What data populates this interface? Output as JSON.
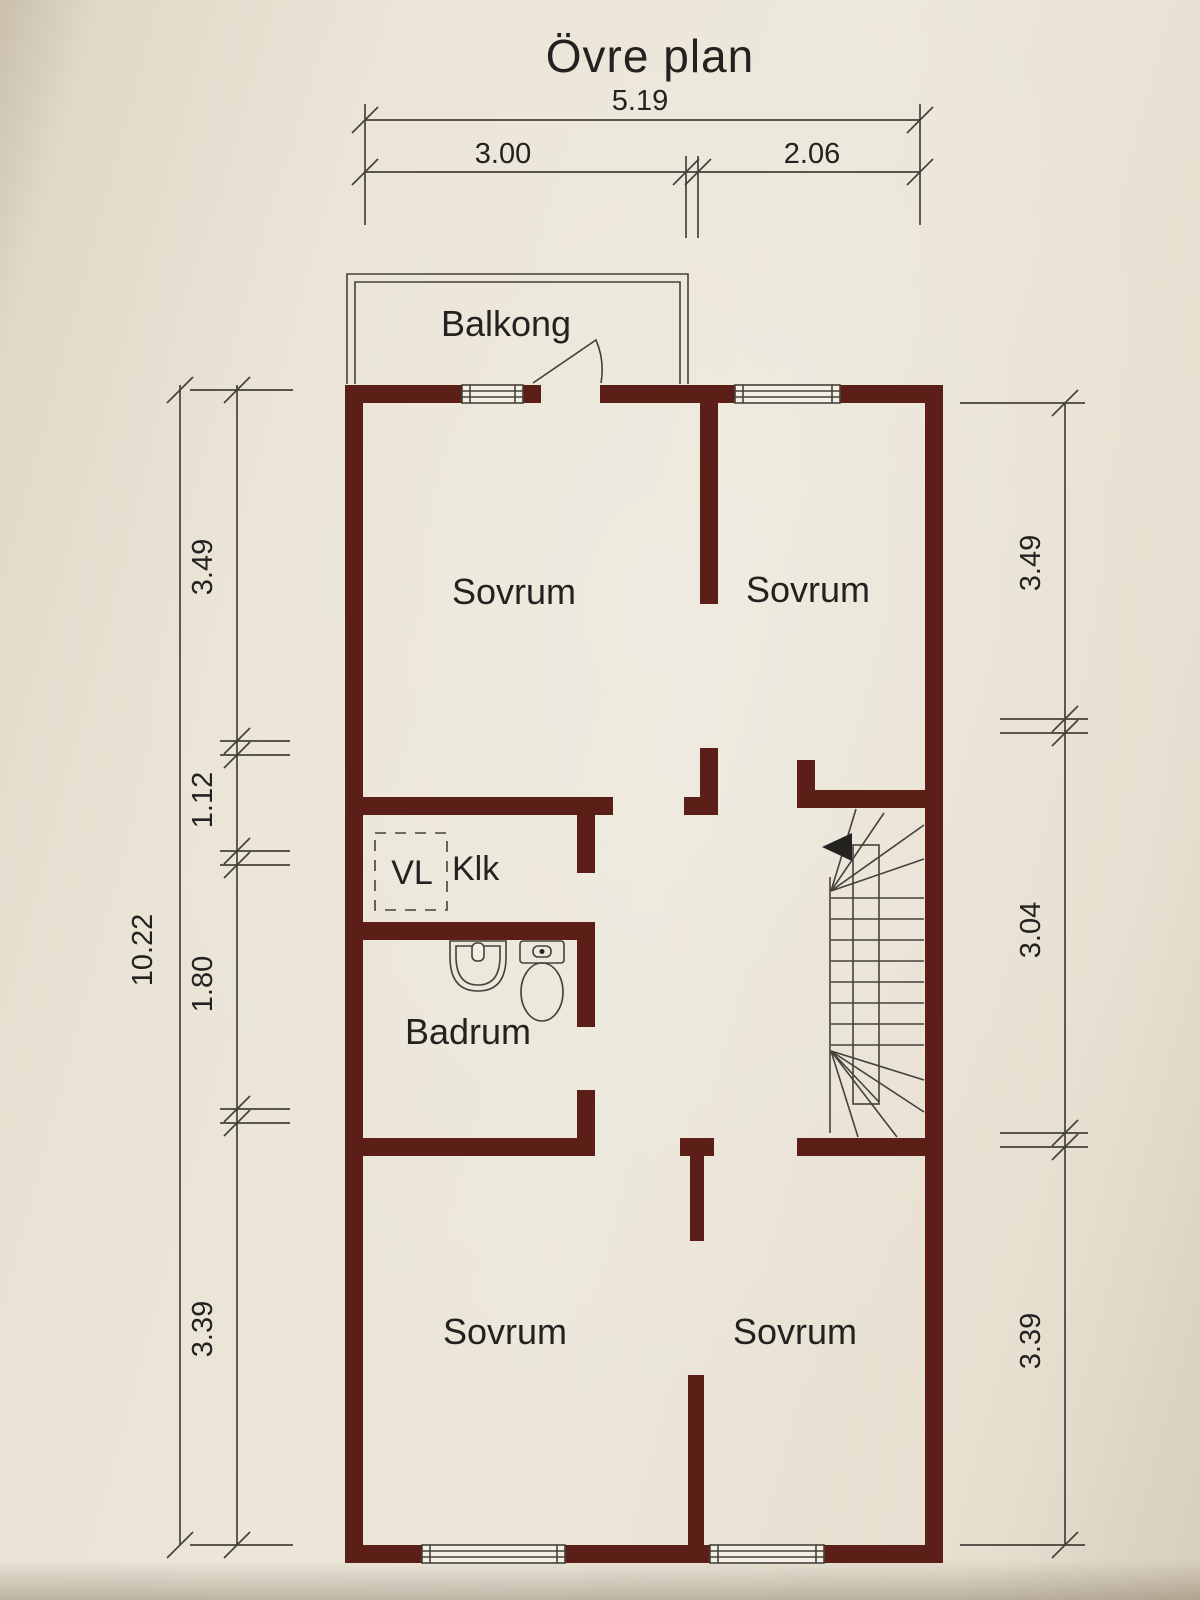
{
  "title": "Övre plan",
  "colors": {
    "wall": "#5c1f18",
    "line": "#45413a",
    "text": "#242220",
    "window_fill": "#f3efe5"
  },
  "dimensions": {
    "top": {
      "total": "5.19",
      "left_part": "3.00",
      "right_part": "2.06"
    },
    "left": {
      "total": "10.22",
      "segments": [
        "3.49",
        "1.12",
        "1.80",
        "3.39"
      ]
    },
    "right": {
      "segments": [
        "3.49",
        "3.04",
        "3.39"
      ]
    }
  },
  "rooms": {
    "balcony": "Balkong",
    "bedroom_top_left": "Sovrum",
    "bedroom_top_right": "Sovrum",
    "ventilation": "VL",
    "closet": "Klk",
    "bathroom": "Badrum",
    "bedroom_bottom_left": "Sovrum",
    "bedroom_bottom_right": "Sovrum"
  }
}
